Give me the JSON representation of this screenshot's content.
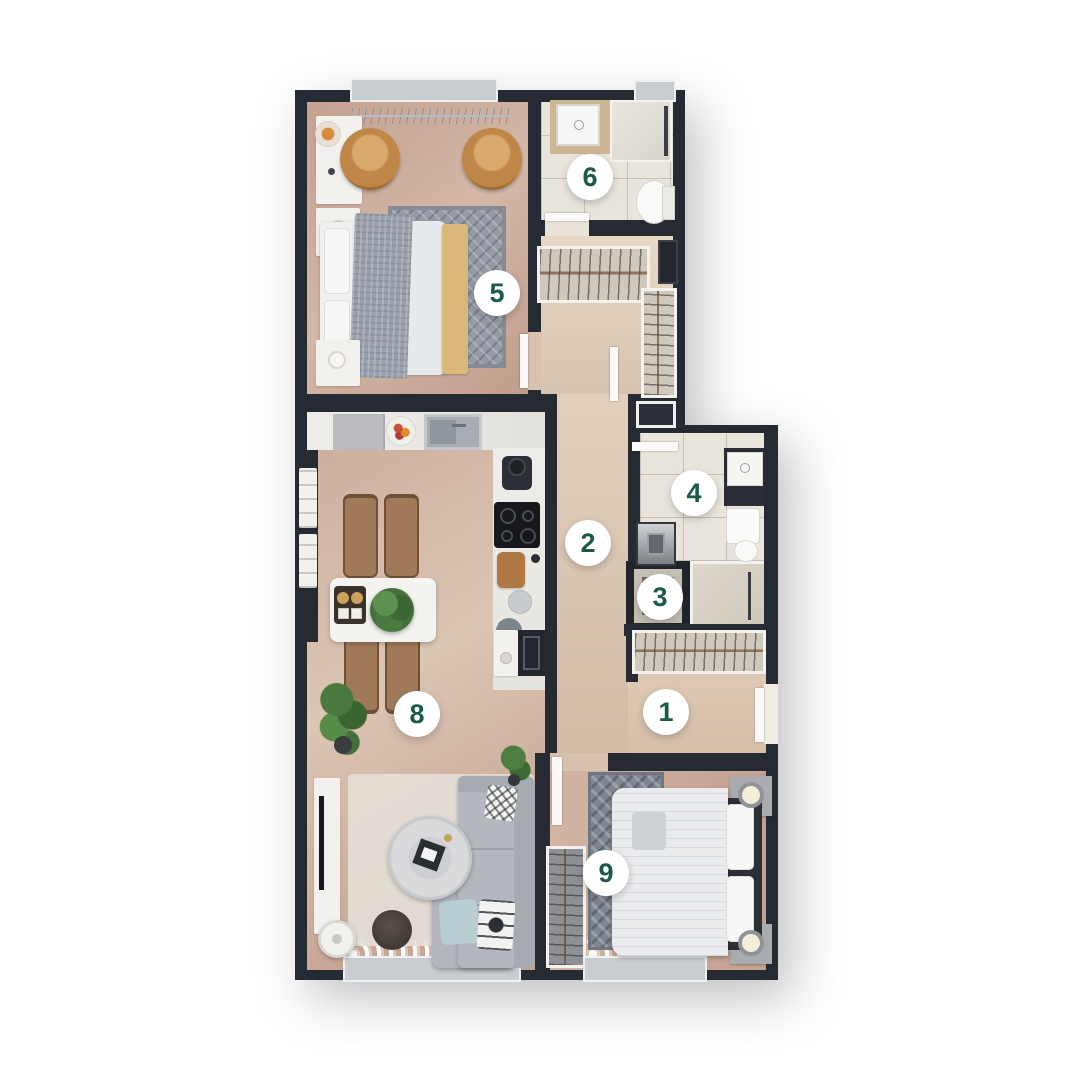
{
  "plan": {
    "type": "apartment-floor-plan",
    "room_markers": [
      {
        "label": "1"
      },
      {
        "label": "2"
      },
      {
        "label": "3"
      },
      {
        "label": "4"
      },
      {
        "label": "5"
      },
      {
        "label": "6"
      },
      {
        "label": "8"
      },
      {
        "label": "9"
      }
    ]
  },
  "palette": {
    "wall": "#262a33",
    "badge_bg": "#ffffff",
    "badge_text": "#1b5a44",
    "floor_wood": "#d0b3a1",
    "floor_tile": "#eae5dc",
    "accent_chair": "#c08948",
    "plant_green": "#4a7a40",
    "background": "#ffffff"
  }
}
